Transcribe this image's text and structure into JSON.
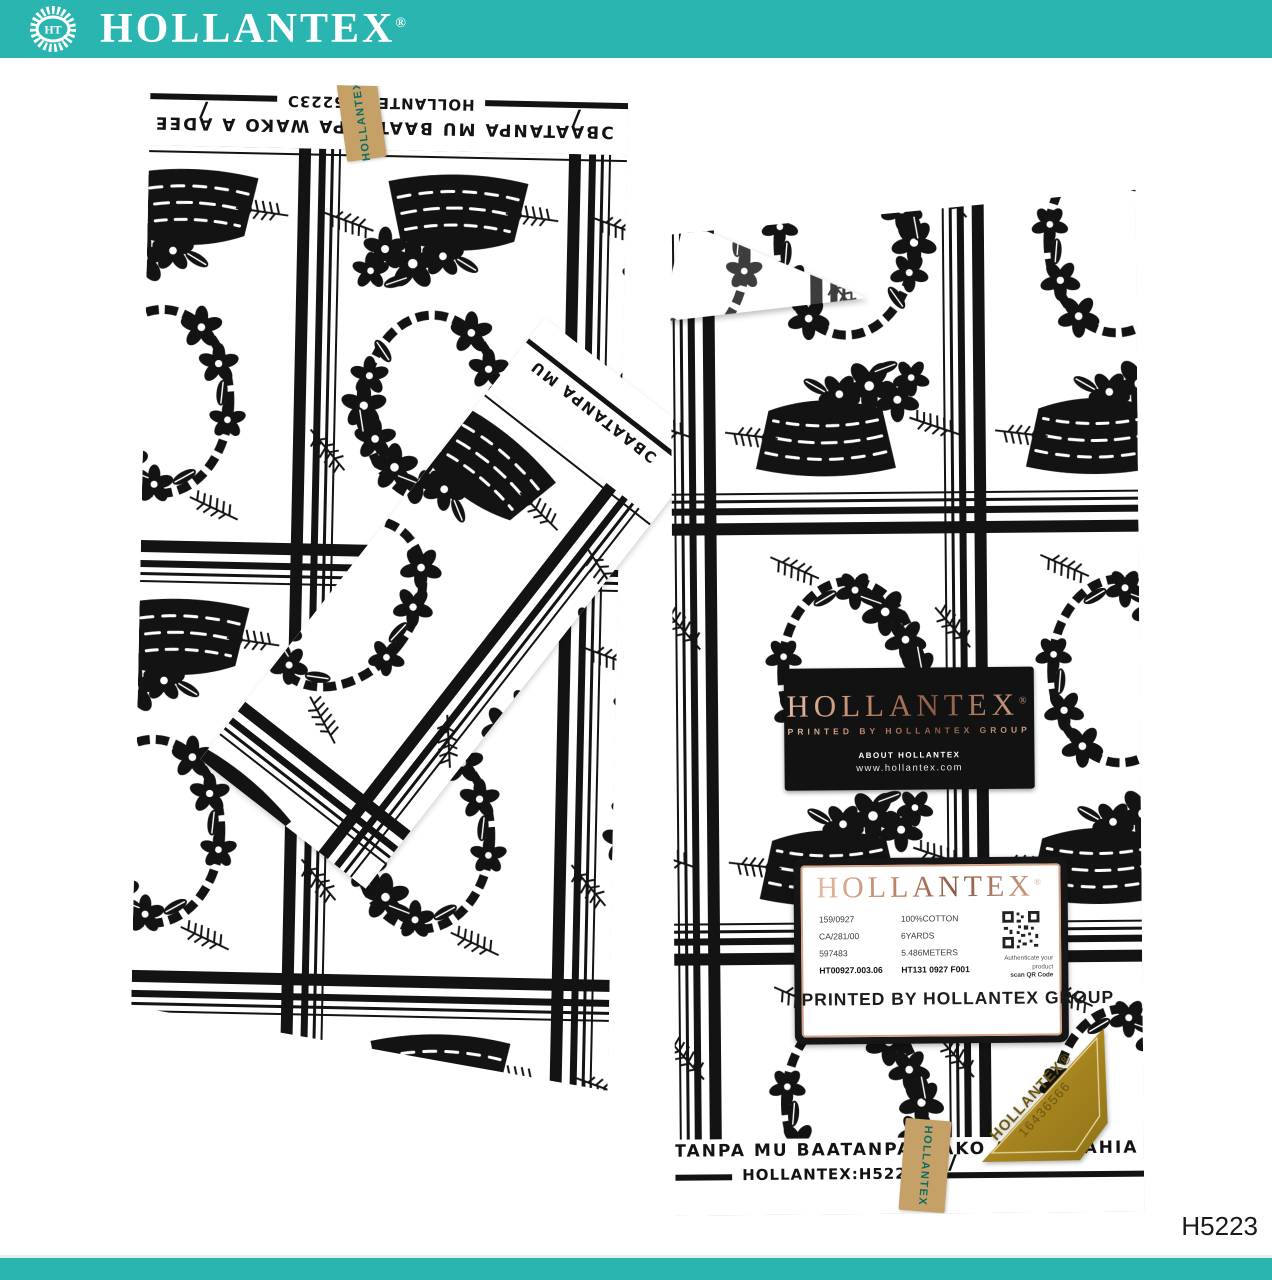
{
  "brand": {
    "name": "HOLLANTEX",
    "reg": "®",
    "monogram": "HT"
  },
  "header": {
    "title": "HOLLANTEX",
    "reg": "®"
  },
  "selvage": {
    "brand_code": "HOLLANTEX:H5223Ɔ",
    "proverb": "ƆBAATANPA MU BAATANPA WAKO A ADEE AHIA YEN",
    "fragment": "ƆBAATANPA MU",
    "tick": "/"
  },
  "sticker": {
    "text": "HOLLANTEX"
  },
  "black_label": {
    "brand": "HOLLANTEX",
    "reg": "®",
    "tagline": "PRINTED BY HOLLANTEX GROUP",
    "about": "ABOUT HOLLANTEX",
    "website": "www.hollantex.com"
  },
  "card_label": {
    "brand": "HOLLANTEX",
    "reg": "®",
    "col1": [
      "159/0927",
      "CA/281/00",
      "597483",
      "HT00927.003.06"
    ],
    "col2": [
      "100%COTTON",
      "6YARDS",
      "5.486METERS",
      "HT131 0927 F001"
    ],
    "qr_caption1": "Authenticate your product",
    "qr_caption2": "scan QR Code",
    "footer": "PRINTED BY HOLLANTEX GROUP"
  },
  "gold_label": {
    "brand": "HOLLANTEX®",
    "number": "16436566"
  },
  "product_code": "H5223",
  "colors": {
    "teal": "#2ab5b1",
    "tan": "#c5a168",
    "gold": "#ab8c28",
    "rose_gold": "#bb8168",
    "ink": "#131313"
  }
}
